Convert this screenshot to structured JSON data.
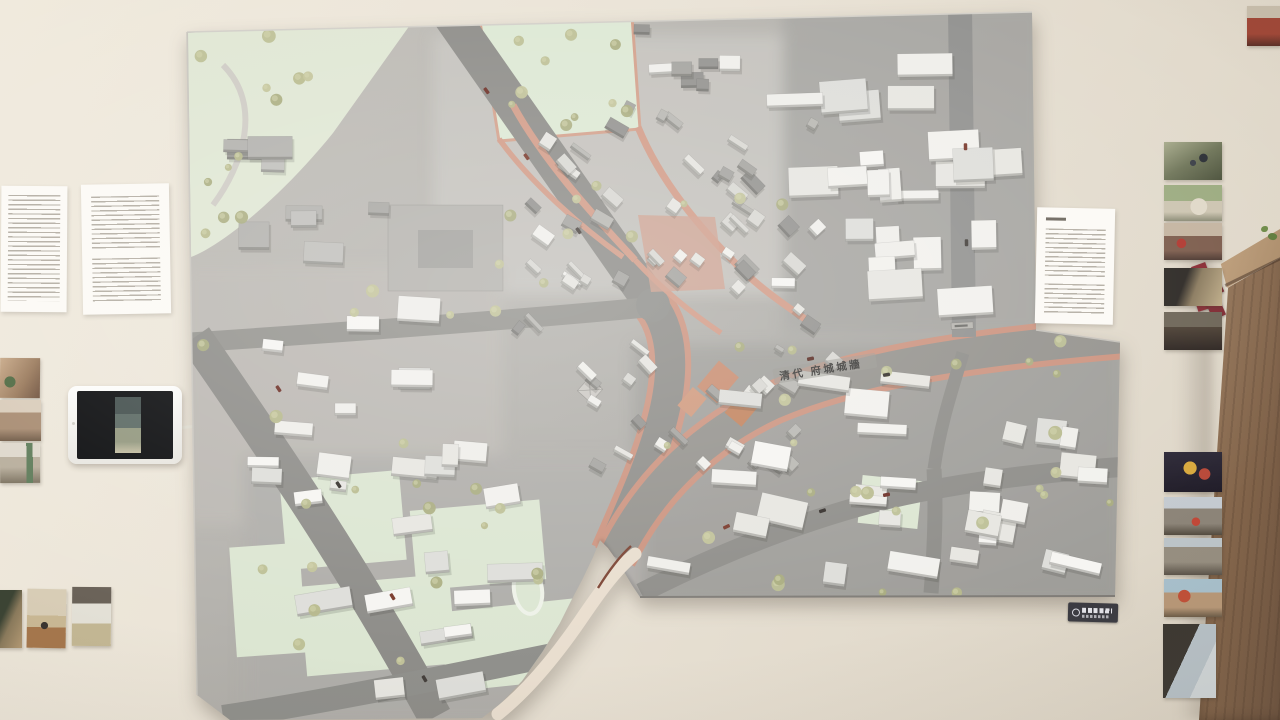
{
  "exhibit": {
    "model_road_label": "清代 府城城牆",
    "tablet": {
      "screen_content": "vertical street video on dark screen"
    },
    "photo_groups": {
      "left_column": 3,
      "bottom_left_row": 3,
      "right_column_upper": 5,
      "right_column_lower": 5,
      "top_right_corner": 1
    },
    "text_panels": {
      "top_left": 2,
      "right_of_model": 1,
      "bottom_right": 1
    }
  },
  "colors": {
    "wall": "#eae3d7",
    "board_gray": "#b2b0ab",
    "road_gray": "#8e8d89",
    "historic_pink": "#cc9480",
    "park_green": "#dfe7d3",
    "building_white": "#f2f1ee",
    "building_gray": "#a7a6a2",
    "wood_brown": "#7c5f46",
    "plaque_bg": "#3b3b42"
  }
}
